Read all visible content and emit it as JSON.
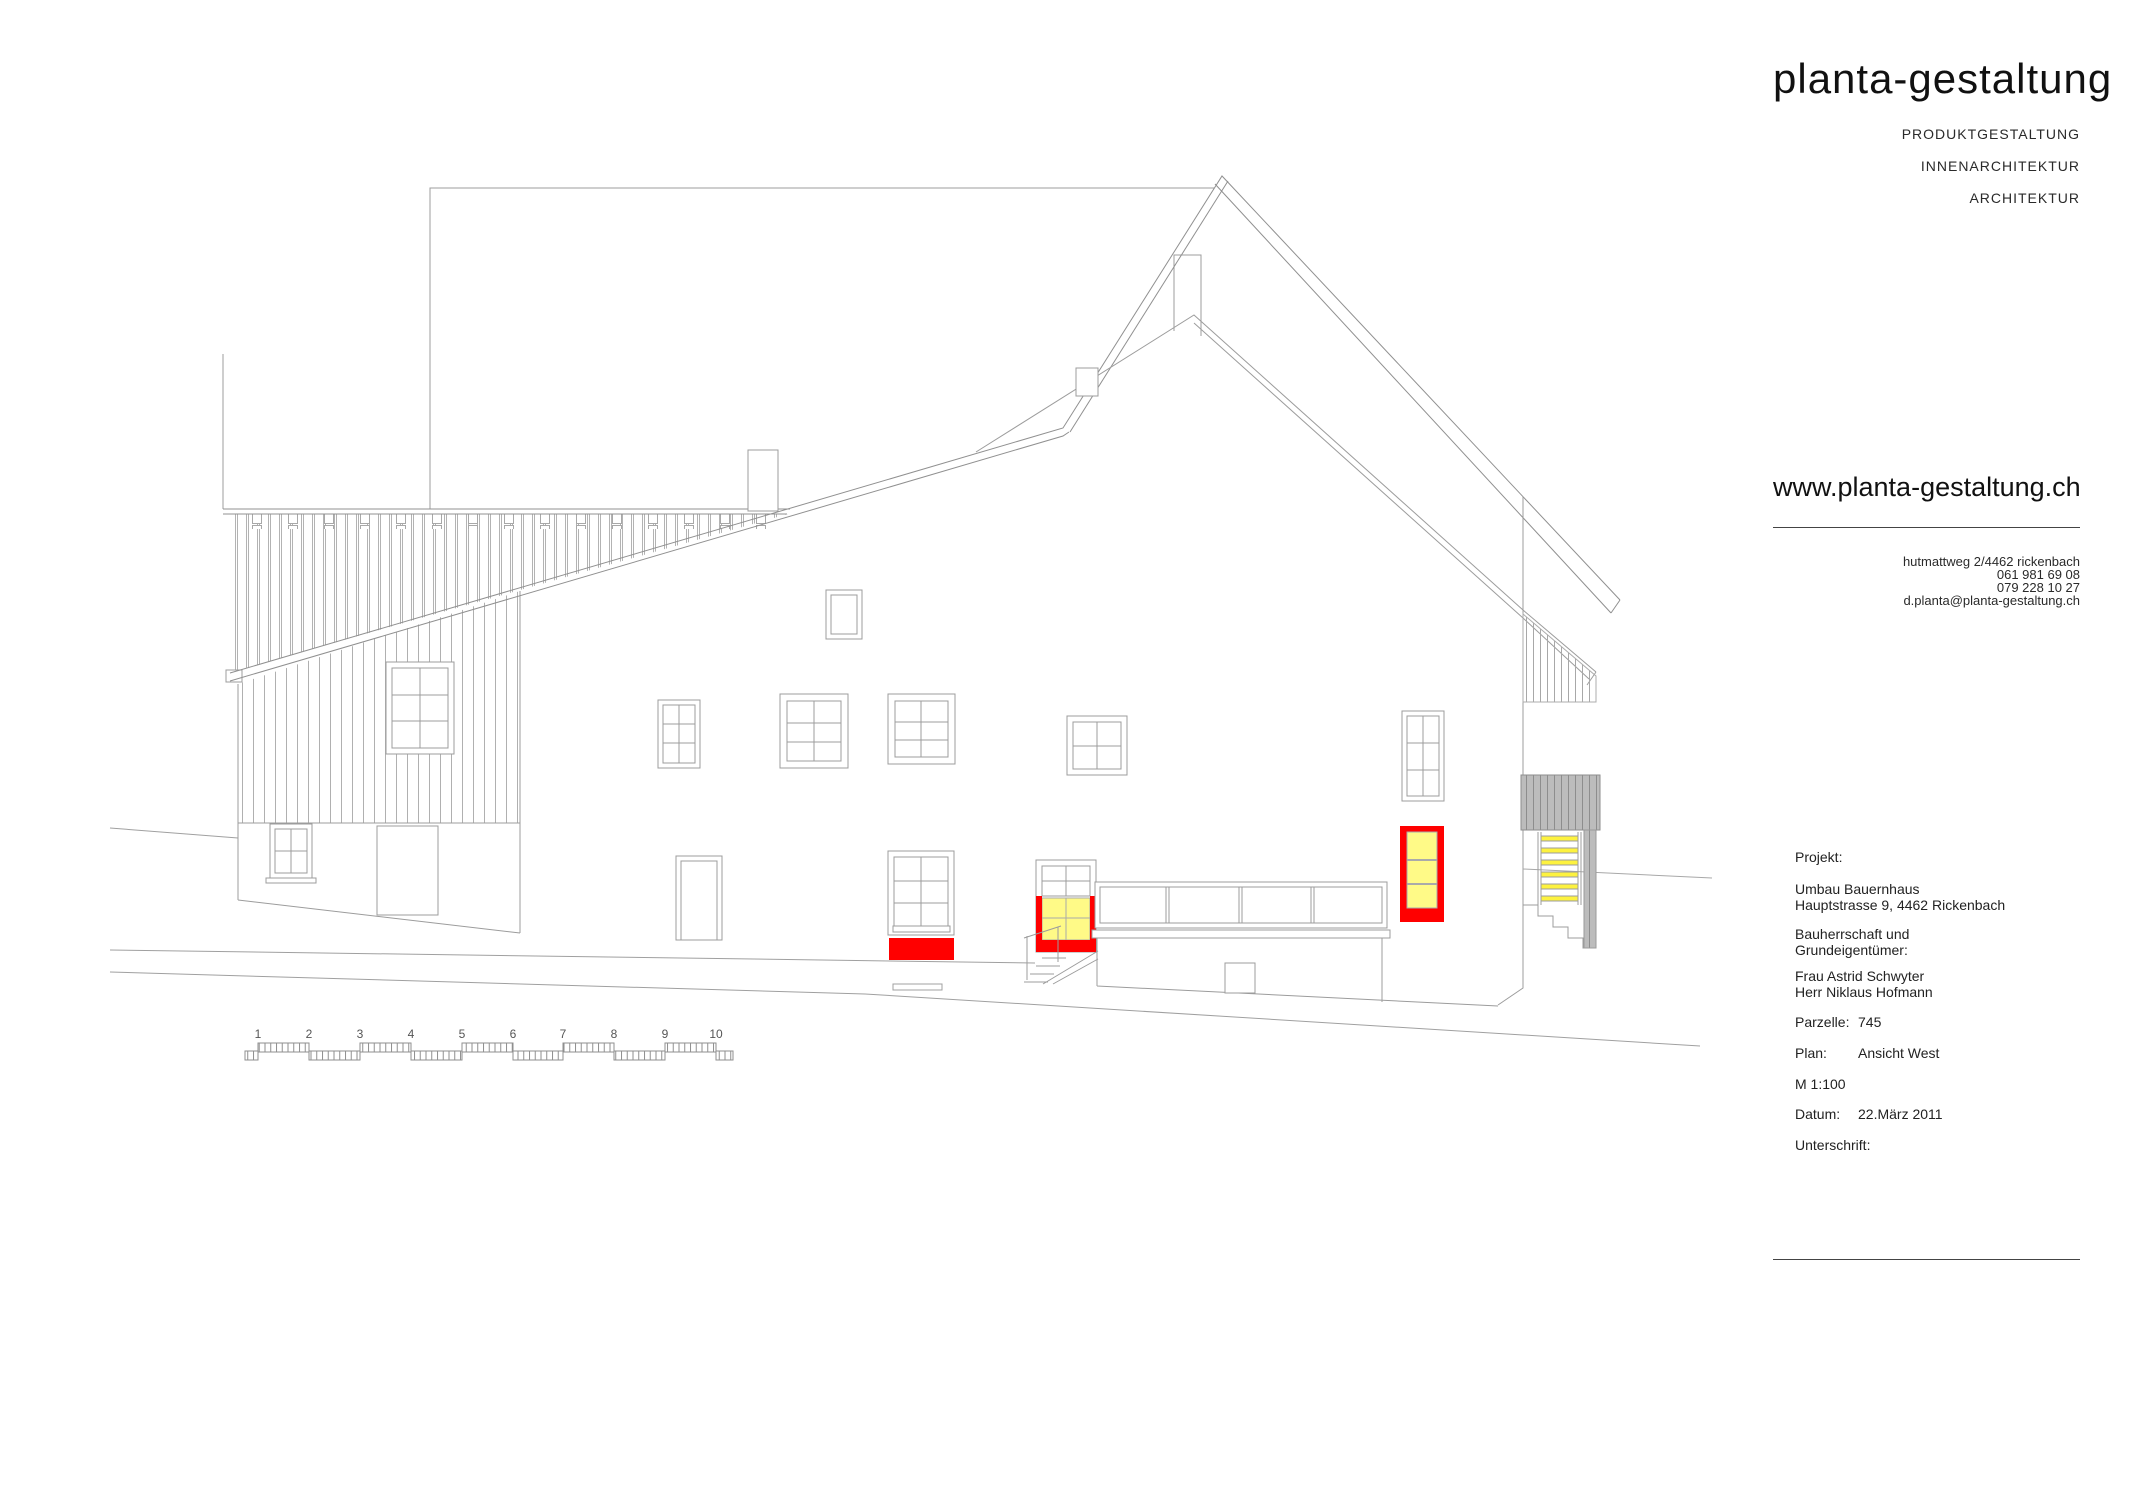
{
  "brand": {
    "logo": "planta-gestaltung",
    "services": [
      "PRODUKTGESTALTUNG",
      "INNENARCHITEKTUR",
      "ARCHITEKTUR"
    ],
    "website": "www.planta-gestaltung.ch",
    "address_line": "hutmattweg 2/4462 rickenbach",
    "phone1": "061 981 69 08",
    "phone2": "079 228 10 27",
    "email": "d.planta@planta-gestaltung.ch"
  },
  "project": {
    "label": "Projekt:",
    "name_line1": "Umbau Bauernhaus",
    "name_line2": "Hauptstrasse 9, 4462 Rickenbach",
    "client_label_line1": "Bauherrschaft und",
    "client_label_line2": "Grundeigentümer:",
    "client1": "Frau Astrid Schwyter",
    "client2": "Herr Niklaus Hofmann"
  },
  "meta": {
    "parzelle_label": "Parzelle:",
    "parzelle": "745",
    "plan_label": "Plan:",
    "plan": "Ansicht West",
    "scale": "M 1:100",
    "datum_label": "Datum:",
    "datum": "22.März 2011",
    "unterschrift_label": "Unterschrift:"
  },
  "scalebar": {
    "labels": [
      "1",
      "2",
      "3",
      "4",
      "5",
      "6",
      "7",
      "8",
      "9",
      "10"
    ]
  },
  "colors": {
    "highlight_red": "#FF0000",
    "highlight_yellow": "#FFFA87",
    "ladder_yellow": "#FDF23F",
    "gray_fill": "#BCBCBC",
    "line": "#9C9C9C"
  }
}
